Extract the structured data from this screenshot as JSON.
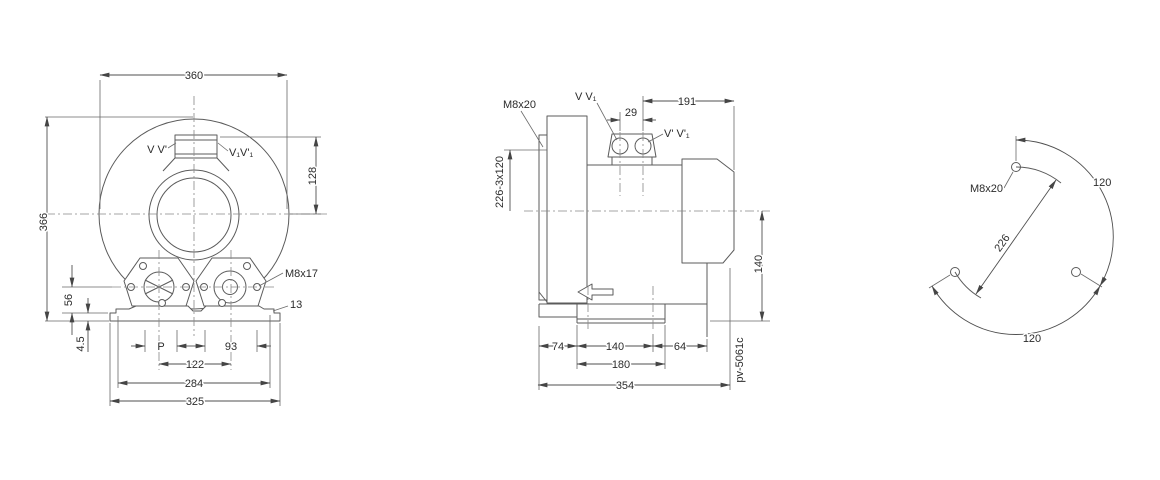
{
  "drawing": {
    "front_view": {
      "port_label_left": "V V'",
      "port_label_right": "V₁V'₁",
      "dim_width": "360",
      "dim_height": "366",
      "dim_port_height": "128",
      "dim_flange_height": "56",
      "dim_base_thickness": "4.5",
      "dim_port": "P",
      "dim_flange_right": "93",
      "dim_flange_spacing": "122",
      "dim_hole_span": "284",
      "dim_base_width": "325",
      "label_thread": "M8x17",
      "label_step": "13"
    },
    "side_view": {
      "label_thread": "M8x20",
      "dim_bolt_circle": "226-3x120",
      "port_label_left": "V V₁",
      "port_label_right": "V' V'₁",
      "dim_port_spacing": "29",
      "dim_motor_length": "191",
      "dim_center_height": "140",
      "dim_foot_left": "74",
      "dim_foot_span": "140",
      "dim_foot_right": "64",
      "dim_foot_width": "180",
      "dim_total_length": "354",
      "code": "pv-5061c"
    },
    "bolt_view": {
      "label_thread": "M8x20",
      "dim_diameter": "226",
      "dim_angle_right": "120",
      "dim_angle_bottom": "120"
    }
  }
}
